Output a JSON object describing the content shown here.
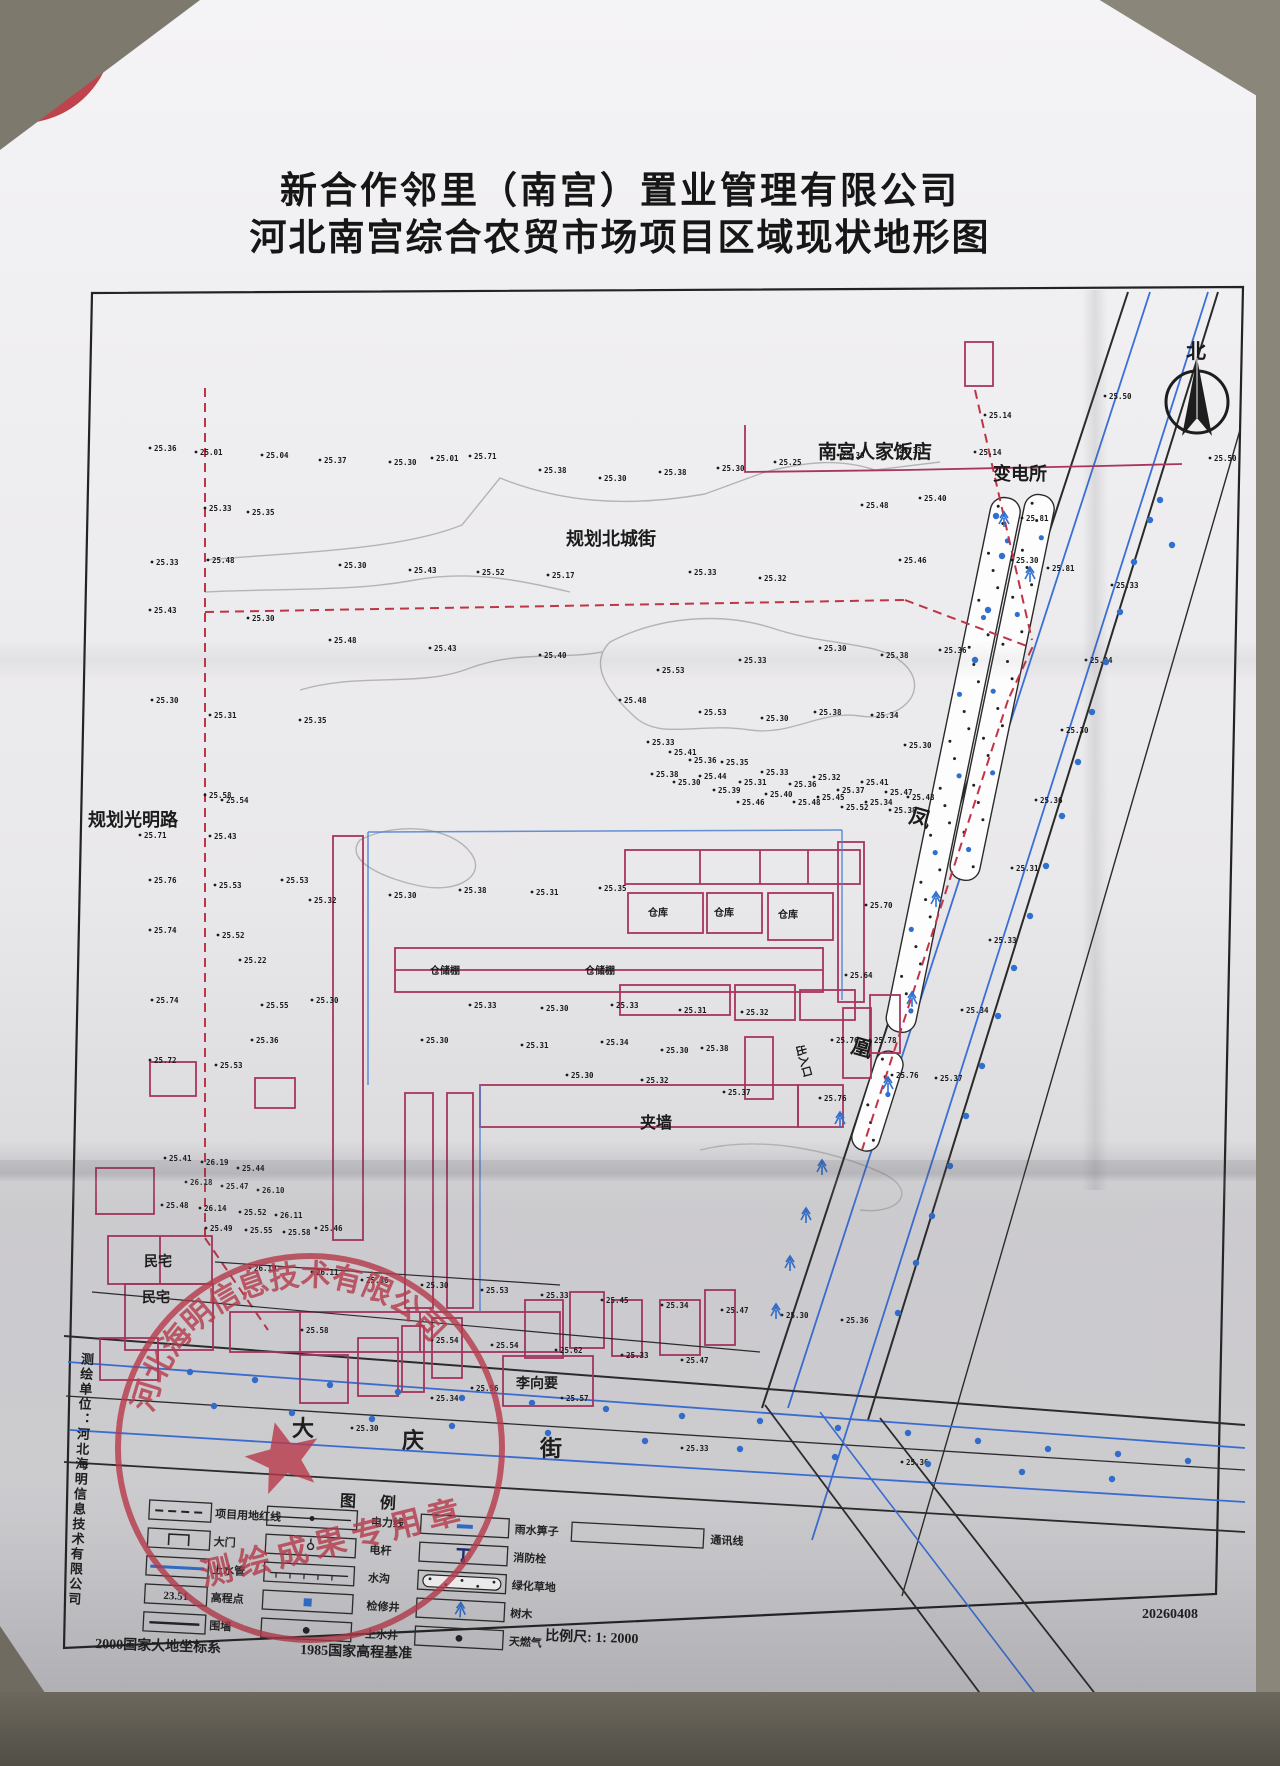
{
  "title": {
    "line1": "新合作邻里（南宫）置业管理有限公司",
    "line2": "河北南宫综合农贸市场项目区域现状地形图"
  },
  "map": {
    "colors": {
      "blue": "#2f6fd0",
      "magenta": "#a8355e",
      "red_dash": "#c03545",
      "black": "#262626"
    },
    "north_label": "北",
    "labels": {
      "restaurant": "南宫人家饭店",
      "substation": "变电所",
      "planned_north_street": "规划北城街",
      "planned_guangming_road": "规划光明路",
      "jiaqiang": "夹墙",
      "li_xiang_yao": "李向要",
      "minzhai_1": "民宅",
      "minzhai_2": "民宅",
      "entrance": "出入口",
      "road_char_1": "凤",
      "road_char_2": "凰",
      "shed_1": "仓储棚",
      "shed_2": "仓储棚",
      "warehouse_1": "仓库",
      "warehouse_2": "仓库",
      "warehouse_3": "仓库"
    },
    "daqing_street": {
      "chars": [
        "大",
        "庆",
        "街"
      ]
    },
    "spot_heights": [
      [
        150,
        448,
        "25.36"
      ],
      [
        196,
        452,
        "25.01"
      ],
      [
        262,
        455,
        "25.04"
      ],
      [
        320,
        460,
        "25.37"
      ],
      [
        390,
        462,
        "25.30"
      ],
      [
        432,
        458,
        "25.01"
      ],
      [
        470,
        456,
        "25.71"
      ],
      [
        540,
        470,
        "25.38"
      ],
      [
        600,
        478,
        "25.30"
      ],
      [
        660,
        472,
        "25.38"
      ],
      [
        718,
        468,
        "25.30"
      ],
      [
        775,
        462,
        "25.25"
      ],
      [
        838,
        455,
        "25.30"
      ],
      [
        895,
        450,
        "25.33"
      ],
      [
        975,
        452,
        "25.14"
      ],
      [
        920,
        498,
        "25.40"
      ],
      [
        862,
        505,
        "25.48"
      ],
      [
        205,
        508,
        "25.33"
      ],
      [
        248,
        512,
        "25.35"
      ],
      [
        152,
        562,
        "25.33"
      ],
      [
        208,
        560,
        "25.48"
      ],
      [
        340,
        565,
        "25.30"
      ],
      [
        410,
        570,
        "25.43"
      ],
      [
        478,
        572,
        "25.52"
      ],
      [
        548,
        575,
        "25.17"
      ],
      [
        690,
        572,
        "25.33"
      ],
      [
        760,
        578,
        "25.32"
      ],
      [
        900,
        560,
        "25.46"
      ],
      [
        1012,
        560,
        "25.30"
      ],
      [
        1048,
        568,
        "25.81"
      ],
      [
        150,
        610,
        "25.43"
      ],
      [
        248,
        618,
        "25.30"
      ],
      [
        330,
        640,
        "25.48"
      ],
      [
        430,
        648,
        "25.43"
      ],
      [
        540,
        655,
        "25.40"
      ],
      [
        658,
        670,
        "25.53"
      ],
      [
        740,
        660,
        "25.33"
      ],
      [
        820,
        648,
        "25.30"
      ],
      [
        882,
        655,
        "25.38"
      ],
      [
        940,
        650,
        "25.36"
      ],
      [
        152,
        700,
        "25.30"
      ],
      [
        210,
        715,
        "25.31"
      ],
      [
        300,
        720,
        "25.35"
      ],
      [
        620,
        700,
        "25.48"
      ],
      [
        700,
        712,
        "25.53"
      ],
      [
        762,
        718,
        "25.30"
      ],
      [
        815,
        712,
        "25.38"
      ],
      [
        872,
        715,
        "25.34"
      ],
      [
        905,
        745,
        "25.30"
      ],
      [
        648,
        742,
        "25.33"
      ],
      [
        670,
        752,
        "25.41"
      ],
      [
        690,
        760,
        "25.36"
      ],
      [
        652,
        774,
        "25.38"
      ],
      [
        674,
        782,
        "25.30"
      ],
      [
        700,
        776,
        "25.44"
      ],
      [
        722,
        762,
        "25.35"
      ],
      [
        714,
        790,
        "25.39"
      ],
      [
        740,
        782,
        "25.31"
      ],
      [
        738,
        802,
        "25.46"
      ],
      [
        762,
        772,
        "25.33"
      ],
      [
        766,
        794,
        "25.40"
      ],
      [
        790,
        784,
        "25.36"
      ],
      [
        794,
        802,
        "25.48"
      ],
      [
        814,
        777,
        "25.32"
      ],
      [
        818,
        797,
        "25.45"
      ],
      [
        838,
        790,
        "25.37"
      ],
      [
        842,
        807,
        "25.52"
      ],
      [
        862,
        782,
        "25.41"
      ],
      [
        866,
        802,
        "25.34"
      ],
      [
        886,
        792,
        "25.47"
      ],
      [
        890,
        810,
        "25.38"
      ],
      [
        908,
        797,
        "25.43"
      ],
      [
        205,
        795,
        "25.58"
      ],
      [
        222,
        800,
        "25.54"
      ],
      [
        140,
        835,
        "25.71"
      ],
      [
        210,
        836,
        "25.43"
      ],
      [
        150,
        880,
        "25.76"
      ],
      [
        215,
        885,
        "25.53"
      ],
      [
        282,
        880,
        "25.53"
      ],
      [
        310,
        900,
        "25.32"
      ],
      [
        390,
        895,
        "25.30"
      ],
      [
        460,
        890,
        "25.38"
      ],
      [
        532,
        892,
        "25.31"
      ],
      [
        600,
        888,
        "25.35"
      ],
      [
        150,
        930,
        "25.74"
      ],
      [
        218,
        935,
        "25.52"
      ],
      [
        240,
        960,
        "25.22"
      ],
      [
        152,
        1000,
        "25.74"
      ],
      [
        262,
        1005,
        "25.55"
      ],
      [
        312,
        1000,
        "25.30"
      ],
      [
        470,
        1005,
        "25.33"
      ],
      [
        542,
        1008,
        "25.30"
      ],
      [
        612,
        1005,
        "25.33"
      ],
      [
        680,
        1010,
        "25.31"
      ],
      [
        742,
        1012,
        "25.32"
      ],
      [
        150,
        1060,
        "25.72"
      ],
      [
        216,
        1065,
        "25.53"
      ],
      [
        252,
        1040,
        "25.36"
      ],
      [
        422,
        1040,
        "25.30"
      ],
      [
        522,
        1045,
        "25.31"
      ],
      [
        602,
        1042,
        "25.34"
      ],
      [
        662,
        1050,
        "25.30"
      ],
      [
        702,
        1048,
        "25.38"
      ],
      [
        567,
        1075,
        "25.30"
      ],
      [
        642,
        1080,
        "25.32"
      ],
      [
        724,
        1092,
        "25.37"
      ],
      [
        870,
        1040,
        "25.78"
      ],
      [
        892,
        1075,
        "25.76"
      ],
      [
        165,
        1158,
        "25.41"
      ],
      [
        202,
        1162,
        "26.19"
      ],
      [
        238,
        1168,
        "25.44"
      ],
      [
        186,
        1182,
        "26.18"
      ],
      [
        222,
        1186,
        "25.47"
      ],
      [
        258,
        1190,
        "26.10"
      ],
      [
        162,
        1205,
        "25.48"
      ],
      [
        200,
        1208,
        "26.14"
      ],
      [
        240,
        1212,
        "25.52"
      ],
      [
        276,
        1215,
        "26.11"
      ],
      [
        206,
        1228,
        "25.49"
      ],
      [
        246,
        1230,
        "25.55"
      ],
      [
        284,
        1232,
        "25.58"
      ],
      [
        316,
        1228,
        "25.46"
      ],
      [
        250,
        1268,
        "26.19"
      ],
      [
        312,
        1272,
        "26.11"
      ],
      [
        362,
        1280,
        "25.36"
      ],
      [
        422,
        1285,
        "25.30"
      ],
      [
        482,
        1290,
        "25.53"
      ],
      [
        542,
        1295,
        "25.33"
      ],
      [
        602,
        1300,
        "25.45"
      ],
      [
        662,
        1305,
        "25.34"
      ],
      [
        722,
        1310,
        "25.47"
      ],
      [
        782,
        1315,
        "25.30"
      ],
      [
        842,
        1320,
        "25.36"
      ],
      [
        302,
        1330,
        "25.58"
      ],
      [
        432,
        1340,
        "25.54"
      ],
      [
        492,
        1345,
        "25.54"
      ],
      [
        556,
        1350,
        "25.62"
      ],
      [
        622,
        1355,
        "25.33"
      ],
      [
        682,
        1360,
        "25.47"
      ],
      [
        472,
        1388,
        "25.56"
      ],
      [
        432,
        1398,
        "25.34"
      ],
      [
        562,
        1398,
        "25.57"
      ],
      [
        352,
        1428,
        "25.30"
      ],
      [
        682,
        1448,
        "25.33"
      ],
      [
        902,
        1462,
        "25.36"
      ],
      [
        866,
        905,
        "25.70"
      ],
      [
        846,
        975,
        "25.64"
      ],
      [
        832,
        1040,
        "25.76"
      ],
      [
        820,
        1098,
        "25.76"
      ],
      [
        936,
        1078,
        "25.37"
      ],
      [
        962,
        1010,
        "25.34"
      ],
      [
        990,
        940,
        "25.33"
      ],
      [
        1012,
        868,
        "25.31"
      ],
      [
        1036,
        800,
        "25.36"
      ],
      [
        1062,
        730,
        "25.30"
      ],
      [
        1086,
        660,
        "25.34"
      ],
      [
        1112,
        585,
        "25.33"
      ],
      [
        1022,
        518,
        "25.81"
      ],
      [
        1105,
        396,
        "25.50"
      ],
      [
        1210,
        458,
        "25.50"
      ],
      [
        985,
        415,
        "25.14"
      ]
    ],
    "blue_dots": [
      [
        190,
        1372
      ],
      [
        255,
        1380
      ],
      [
        330,
        1385
      ],
      [
        398,
        1392
      ],
      [
        462,
        1398
      ],
      [
        532,
        1403
      ],
      [
        606,
        1409
      ],
      [
        682,
        1416
      ],
      [
        760,
        1421
      ],
      [
        838,
        1428
      ],
      [
        908,
        1433
      ],
      [
        978,
        1441
      ],
      [
        1048,
        1449
      ],
      [
        1118,
        1454
      ],
      [
        1188,
        1461
      ],
      [
        214,
        1406
      ],
      [
        292,
        1413
      ],
      [
        372,
        1419
      ],
      [
        452,
        1426
      ],
      [
        548,
        1433
      ],
      [
        645,
        1441
      ],
      [
        740,
        1449
      ],
      [
        835,
        1457
      ],
      [
        928,
        1464
      ],
      [
        1022,
        1472
      ],
      [
        1112,
        1479
      ],
      [
        1150,
        520
      ],
      [
        1134,
        562
      ],
      [
        1120,
        612
      ],
      [
        1106,
        662
      ],
      [
        1092,
        712
      ],
      [
        1078,
        762
      ],
      [
        1062,
        816
      ],
      [
        1046,
        866
      ],
      [
        1030,
        916
      ],
      [
        1014,
        968
      ],
      [
        998,
        1016
      ],
      [
        982,
        1066
      ],
      [
        966,
        1116
      ],
      [
        950,
        1166
      ],
      [
        932,
        1216
      ],
      [
        916,
        1263
      ],
      [
        898,
        1313
      ],
      [
        1160,
        500
      ],
      [
        1172,
        545
      ],
      [
        996,
        516
      ],
      [
        1002,
        556
      ],
      [
        988,
        610
      ],
      [
        975,
        660
      ]
    ],
    "trees": [
      [
        840,
        1120
      ],
      [
        822,
        1168
      ],
      [
        806,
        1216
      ],
      [
        790,
        1264
      ],
      [
        776,
        1312
      ],
      [
        936,
        900
      ],
      [
        912,
        1000
      ],
      [
        888,
        1085
      ],
      [
        1004,
        520
      ],
      [
        1030,
        575
      ]
    ]
  },
  "legend": {
    "title": "图 例",
    "elev_value": "23.51",
    "rows": [
      [
        {
          "s": "black-dash",
          "l": "项目用地红线"
        },
        {
          "s": "power",
          "l": "电力线"
        },
        {
          "s": "blue-dash",
          "l": "雨水箅子"
        },
        {
          "s": "wide",
          "l": "通讯线"
        }
      ],
      [
        {
          "s": "gate",
          "l": "大门"
        },
        {
          "s": "pole",
          "l": "电杆"
        },
        {
          "s": "hydrant",
          "l": "消防栓"
        },
        null
      ],
      [
        {
          "s": "blue-line",
          "l": "上水管"
        },
        {
          "s": "ditch",
          "l": "水沟"
        },
        {
          "s": "greenbelt",
          "l": "绿化草地"
        },
        null
      ],
      [
        {
          "s": "elev",
          "l": "高程点"
        },
        {
          "s": "manhole",
          "l": "检修井"
        },
        {
          "s": "tree",
          "l": "树木"
        },
        null
      ],
      [
        {
          "s": "solid",
          "l": "围墙"
        },
        {
          "s": "dot",
          "l": "上水井"
        },
        {
          "s": "dot",
          "l": "天燃气"
        },
        null
      ]
    ]
  },
  "footer": {
    "datum_plane": "2000国家大地坐标系",
    "height_datum": "1985国家高程基准",
    "scale": "比例尺: 1: 2000",
    "date_code": "20260408",
    "survey_unit": "测绘单位：河北海明信息技术有限公司"
  },
  "stamps": {
    "round_stamp": {
      "company": "河北海明信息技术有限公司",
      "caption": "测绘成果专用章"
    }
  }
}
